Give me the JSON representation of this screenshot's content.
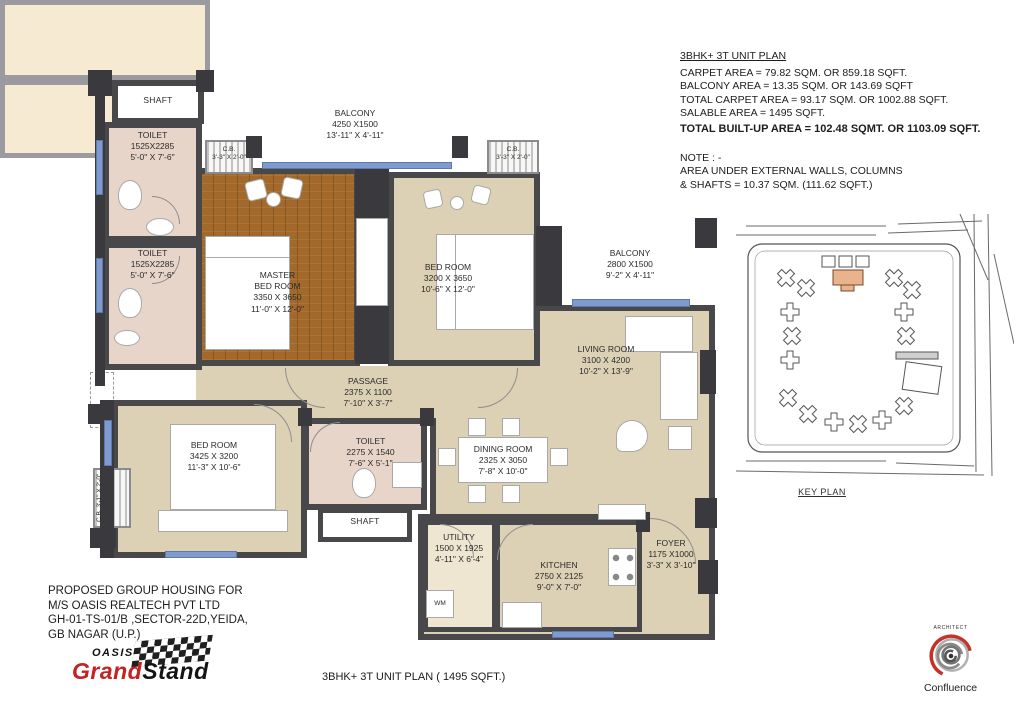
{
  "info_panel": {
    "title": "3BHK+ 3T UNIT PLAN",
    "lines": [
      "CARPET AREA = 79.82 SQM. OR 859.18 SQFT.",
      "BALCONY AREA = 13.35 SQM. OR 143.69 SQFT",
      "TOTAL CARPET AREA = 93.17 SQM. OR 1002.88 SQFT.",
      "SALABLE AREA =  1495 SQFT."
    ],
    "total_line": "TOTAL BUILT-UP AREA = 102.48 SQMT. OR 1103.09 SQFT.",
    "note_title": "NOTE : -",
    "note_lines": [
      "AREA UNDER EXTERNAL WALLS, COLUMNS",
      "& SHAFTS = 10.37 SQM. (111.62 SQFT.)"
    ]
  },
  "rooms": {
    "shaft_top": {
      "name": "SHAFT"
    },
    "toilet1": {
      "name": "TOILET",
      "mm": "1525X2285",
      "ft": "5'-0\" X 7'-6\""
    },
    "toilet2": {
      "name": "TOILET",
      "mm": "1525X2285",
      "ft": "5'-0\" X 7'-6\""
    },
    "cb1": {
      "name": "C.B.",
      "ft": "3'-3\" X 2'-0\""
    },
    "balcony1": {
      "name": "BALCONY",
      "mm": "4250 X1500",
      "ft": "13'-11\" X 4'-11\""
    },
    "cb2": {
      "name": "C.B.",
      "ft": "3'-3\" X 2'-0\""
    },
    "master": {
      "name": "MASTER\nBED ROOM",
      "mm": "3350 X 3650",
      "ft": "11'-0\" X 12'-0\""
    },
    "bedroom2": {
      "name": "BED ROOM",
      "mm": "3200 X 3650",
      "ft": "10'-6\" X 12'-0\""
    },
    "balcony2": {
      "name": "BALCONY",
      "mm": "2800 X1500",
      "ft": "9'-2\" X 4'-11\""
    },
    "living": {
      "name": "LIVING ROOM",
      "mm": "3100 X 4200",
      "ft": "10'-2\" X 13'-9\""
    },
    "passage": {
      "name": "PASSAGE",
      "mm": "2375 X 1100",
      "ft": "7'-10\" X 3'-7\""
    },
    "bedroom3": {
      "name": "BED ROOM",
      "mm": "3425 X 3200",
      "ft": "11'-3\" X 10'-6\""
    },
    "toilet3": {
      "name": "TOILET",
      "mm": "2275 X 1540",
      "ft": "7'-6\" X 5'-1\""
    },
    "shaft_bottom": {
      "name": "SHAFT"
    },
    "dining": {
      "name": "DINING ROOM",
      "mm": "2325 X 3050",
      "ft": "7'-8\" X 10'-0\""
    },
    "utility": {
      "name": "UTILITY",
      "mm": "1500 X 1925",
      "ft": "4'-11\" X 6'-4\""
    },
    "kitchen": {
      "name": "KITCHEN",
      "mm": "2750 X 2125",
      "ft": "9'-0\" X 7'-0\""
    },
    "foyer": {
      "name": "FOYER",
      "mm": "1175 X1000",
      "ft": "3'-3\" X 3'-10\""
    },
    "cb3": {
      "name": "C.B.",
      "ft": "3'-1\" X 2'-0\""
    },
    "wm": {
      "name": "WM"
    }
  },
  "key_plan": {
    "label": "KEY PLAN"
  },
  "project": {
    "lines": [
      "PROPOSED GROUP HOUSING  FOR",
      "M/S OASIS REALTECH  PVT LTD",
      "GH-01-TS-01/B ,SECTOR-22D,YEIDA,",
      "GB NAGAR (U.P.)"
    ]
  },
  "brand": {
    "oasis": "OASIS",
    "grand": "Grand",
    "stand": "Stand"
  },
  "architect": {
    "label": "ARCHITECT",
    "name": "Confluence"
  },
  "footer": {
    "caption": "3BHK+ 3T UNIT PLAN ( 1495 SQFT.)"
  },
  "colors": {
    "wall": "#48484b",
    "floor": "#ddd1b5",
    "wood": "#a2692a",
    "toilet_floor": "#e7d5ca",
    "balcony_floor": "#f6ebd2",
    "window": "#7e9ace",
    "accent_red": "#c52222",
    "keyplan_highlight": "#e9b38d"
  }
}
